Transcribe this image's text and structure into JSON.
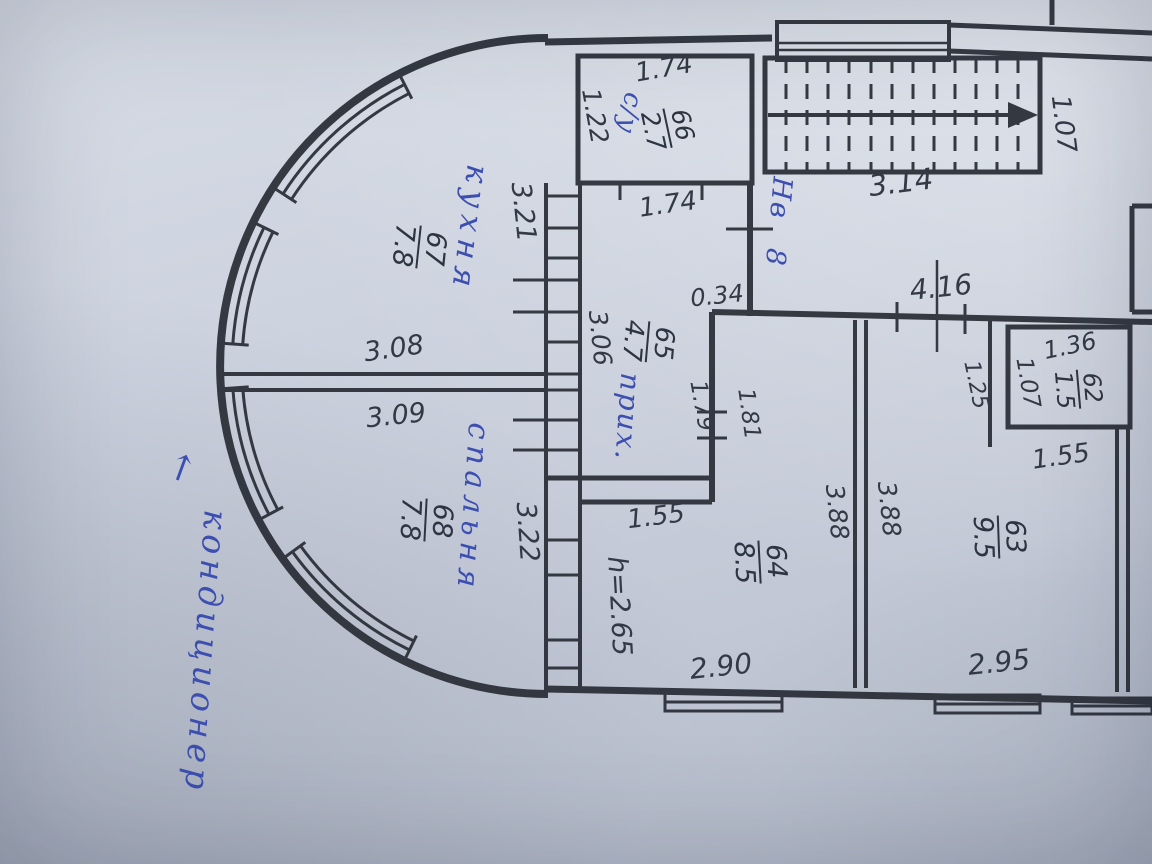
{
  "document": {
    "kind": "floor-plan-photo",
    "language": "ru"
  },
  "colors": {
    "paper": "#c9cfdb",
    "ink": "#272c35",
    "pen_blue": "#3c4fb0"
  },
  "legend": {
    "rooms": [
      {
        "number": "66",
        "area_m2": "2.7",
        "name": "с/у"
      },
      {
        "number": "67",
        "area_m2": "7.8",
        "name": "кухня"
      },
      {
        "number": "68",
        "area_m2": "7.8",
        "name": "спальня"
      },
      {
        "number": "65",
        "area_m2": "4.7",
        "name": "прих."
      },
      {
        "number": "64",
        "area_m2": "8.5",
        "name": ""
      },
      {
        "number": "63",
        "area_m2": "9.5",
        "name": ""
      },
      {
        "number": "62",
        "area_m2": "1.5",
        "name": ""
      }
    ],
    "notes": [
      "кондиционер",
      "Нв 8",
      "h=2.65"
    ]
  },
  "labels": {
    "dims": [
      {
        "id": "su-width-top",
        "text": "1.74",
        "x": 664,
        "y": 69,
        "rot": -10,
        "size": 26
      },
      {
        "id": "su-depth",
        "text": "1.22",
        "x": 595,
        "y": 116,
        "rot": 80,
        "size": 25
      },
      {
        "id": "hall-width-top",
        "text": "1.74",
        "x": 668,
        "y": 205,
        "rot": -8,
        "size": 26
      },
      {
        "id": "kitchen-east-wall",
        "text": "3.21",
        "x": 523,
        "y": 212,
        "rot": 84,
        "size": 27
      },
      {
        "id": "kitchen-width",
        "text": "3.08",
        "x": 394,
        "y": 349,
        "rot": -8,
        "size": 27
      },
      {
        "id": "bedroom-width",
        "text": "3.09",
        "x": 396,
        "y": 416,
        "rot": -6,
        "size": 27
      },
      {
        "id": "bedroom-east-wall",
        "text": "3.22",
        "x": 527,
        "y": 532,
        "rot": 86,
        "size": 27
      },
      {
        "id": "hall-length",
        "text": "3.06",
        "x": 600,
        "y": 338,
        "rot": 84,
        "size": 25
      },
      {
        "id": "stub-width",
        "text": "0.34",
        "x": 717,
        "y": 296,
        "rot": -6,
        "size": 24
      },
      {
        "id": "hall-side",
        "text": "1.79",
        "x": 701,
        "y": 406,
        "rot": 80,
        "size": 23
      },
      {
        "id": "room64-side",
        "text": "1.81",
        "x": 748,
        "y": 414,
        "rot": 82,
        "size": 23
      },
      {
        "id": "stairs-length",
        "text": "3.14",
        "x": 901,
        "y": 183,
        "rot": -7,
        "size": 29
      },
      {
        "id": "stairs-width",
        "text": "1.07",
        "x": 1063,
        "y": 124,
        "rot": 83,
        "size": 26
      },
      {
        "id": "corridor-length",
        "text": "4.16",
        "x": 941,
        "y": 288,
        "rot": -6,
        "size": 28
      },
      {
        "id": "shaft-width",
        "text": "1.25",
        "x": 975,
        "y": 385,
        "rot": 78,
        "size": 22
      },
      {
        "id": "wc-width",
        "text": "1.36",
        "x": 1070,
        "y": 346,
        "rot": -12,
        "size": 24
      },
      {
        "id": "wc-depth",
        "text": "1.07",
        "x": 1027,
        "y": 383,
        "rot": 80,
        "size": 23
      },
      {
        "id": "wc-bottom",
        "text": "1.55",
        "x": 1061,
        "y": 457,
        "rot": -8,
        "size": 26
      },
      {
        "id": "room64-depth",
        "text": "3.88",
        "x": 837,
        "y": 512,
        "rot": 84,
        "size": 25
      },
      {
        "id": "room63-depth",
        "text": "3.88",
        "x": 889,
        "y": 509,
        "rot": 84,
        "size": 25
      },
      {
        "id": "room64-step",
        "text": "1.55",
        "x": 656,
        "y": 517,
        "rot": -7,
        "size": 26
      },
      {
        "id": "ceiling-height",
        "text": "h=2.65",
        "x": 619,
        "y": 606,
        "rot": 87,
        "size": 27
      },
      {
        "id": "room64-width",
        "text": "2.90",
        "x": 721,
        "y": 667,
        "rot": -6,
        "size": 28
      },
      {
        "id": "room63-width",
        "text": "2.95",
        "x": 999,
        "y": 663,
        "rot": -6,
        "size": 28
      }
    ],
    "rooms": [
      {
        "id": "66",
        "num": "66",
        "area": "2.7",
        "x": 668,
        "y": 128,
        "rot": 78,
        "size": 25
      },
      {
        "id": "67",
        "num": "67",
        "area": "7.8",
        "x": 419,
        "y": 247,
        "rot": 96,
        "size": 27
      },
      {
        "id": "68",
        "num": "68",
        "area": "7.8",
        "x": 426,
        "y": 520,
        "rot": 93,
        "size": 27
      },
      {
        "id": "65",
        "num": "65",
        "area": "4.7",
        "x": 648,
        "y": 342,
        "rot": 95,
        "size": 26
      },
      {
        "id": "64",
        "num": "64",
        "area": "8.5",
        "x": 760,
        "y": 562,
        "rot": 87,
        "size": 27
      },
      {
        "id": "63",
        "num": "63",
        "area": "9.5",
        "x": 999,
        "y": 537,
        "rot": 88,
        "size": 27
      },
      {
        "id": "62",
        "num": "62",
        "area": "1.5",
        "x": 1078,
        "y": 389,
        "rot": 85,
        "size": 24
      }
    ],
    "blue": [
      {
        "id": "su",
        "text": "с/у",
        "x": 629,
        "y": 113,
        "rot": 102,
        "size": 26,
        "ls": 1
      },
      {
        "id": "kitchen",
        "text": "кухня",
        "x": 469,
        "y": 229,
        "rot": 97,
        "size": 31,
        "ls": 7
      },
      {
        "id": "bedroom",
        "text": "спальня",
        "x": 472,
        "y": 508,
        "rot": 94,
        "size": 30,
        "ls": 6
      },
      {
        "id": "hallway",
        "text": "прих.",
        "x": 627,
        "y": 417,
        "rot": 94,
        "size": 28,
        "ls": 2
      },
      {
        "id": "nv8",
        "text": "Нв 8",
        "x": 778,
        "y": 222,
        "rot": 95,
        "size": 27,
        "ls": 2,
        "ws": 18
      },
      {
        "id": "aircon",
        "text": "кондиционер",
        "x": 206,
        "y": 652,
        "rot": 94,
        "size": 33,
        "ls": 5
      },
      {
        "id": "aircon-arrow",
        "text": "↑",
        "x": 181,
        "y": 470,
        "rot": 20,
        "size": 36,
        "ls": 0
      }
    ]
  }
}
